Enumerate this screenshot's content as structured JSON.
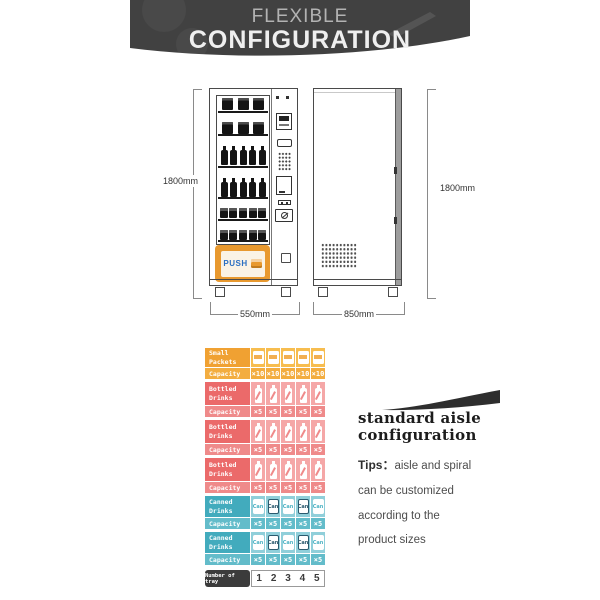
{
  "banner": {
    "line1": "FLEXIBLE",
    "line2": "CONFIGURATION"
  },
  "diagrams": {
    "front": {
      "height_label": "1800mm",
      "width_label": "550mm",
      "push_label": "PUSH",
      "shelves": [
        {
          "type": "box",
          "count": 3
        },
        {
          "type": "box",
          "count": 3
        },
        {
          "type": "bottle",
          "count": 5
        },
        {
          "type": "bottle",
          "count": 5
        },
        {
          "type": "can",
          "count": 5
        },
        {
          "type": "can",
          "count": 5
        }
      ]
    },
    "side": {
      "height_label": "1800mm",
      "width_label": "850mm"
    }
  },
  "config_table": {
    "capacity_label": "Capacity",
    "can_text": "Can",
    "rows": [
      {
        "name": "Small\nPackets",
        "type": "packet",
        "capacities": [
          "×10",
          "×10",
          "×10",
          "×10",
          "×10"
        ]
      },
      {
        "name": "Bottled\nDrinks",
        "type": "bottle",
        "capacities": [
          "×5",
          "×5",
          "×5",
          "×5",
          "×5"
        ]
      },
      {
        "name": "Bottled\nDrinks",
        "type": "bottle",
        "capacities": [
          "×5",
          "×5",
          "×5",
          "×5",
          "×5"
        ]
      },
      {
        "name": "Bottled\nDrinks",
        "type": "bottle",
        "capacities": [
          "×5",
          "×5",
          "×5",
          "×5",
          "×5"
        ]
      },
      {
        "name": "Canned\nDrinks",
        "type": "can",
        "capacities": [
          "×5",
          "×5",
          "×5",
          "×5",
          "×5"
        ]
      },
      {
        "name": "Canned\nDrinks",
        "type": "can",
        "capacities": [
          "×5",
          "×5",
          "×5",
          "×5",
          "×5"
        ]
      }
    ],
    "tray": {
      "label": "Number of tray",
      "numbers": [
        "1",
        "2",
        "3",
        "4",
        "5"
      ]
    }
  },
  "aside": {
    "heading": "standard aisle\nconfiguration",
    "tips_label": "Tips：",
    "tips_text": "aisle and spiral\ncan be customized\naccording to the\nproduct sizes"
  },
  "colors": {
    "banner_bg": "#414141",
    "orange_dark": "#F0A132",
    "orange_mid": "#F3AD40",
    "orange_light": "#F7BD4F",
    "red_dark": "#EB6A6A",
    "red_mid": "#EF8A8A",
    "red_light": "#F5A7A7",
    "teal_dark": "#42ABBD",
    "teal_mid": "#63BCCA",
    "teal_light": "#90CFDA",
    "push_frame_orange": "#E8992F",
    "push_text_blue": "#2B6FC2",
    "tray_label_bg": "#3B3B3B"
  }
}
